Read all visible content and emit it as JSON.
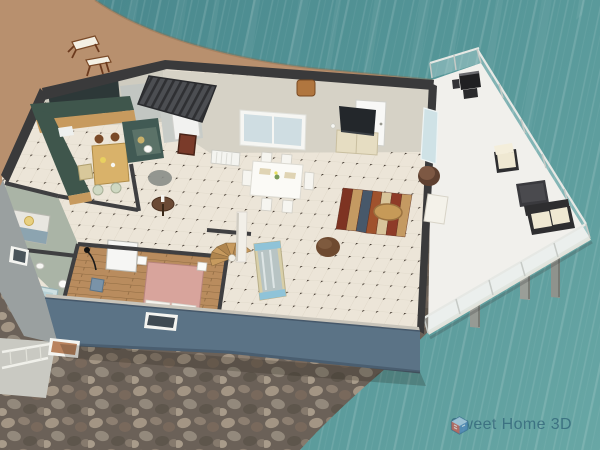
{
  "app": {
    "watermark_text": "Sweet Home 3D"
  },
  "view": {
    "type": "3d-aerial-home-render",
    "description": "Aerial 3D view of a furnished single-storey beach house built on stilts over a pebble shore and teal sea, with a white railed terrace deck, sandy beach with two wooden deck chairs at top left"
  },
  "rooms": [
    {
      "id": "kitchen",
      "label": "kitchen with L-shaped teal counter and small wooden table"
    },
    {
      "id": "wc",
      "label": "dark teal water closet"
    },
    {
      "id": "dining-area",
      "label": "dining area with white table and four chairs"
    },
    {
      "id": "living-room",
      "label": "living room with TV cabinet, striped rug, armchair, leaning mirror, spiral stairs"
    },
    {
      "id": "bedroom",
      "label": "bedroom with pink double bed on wood floor"
    },
    {
      "id": "bathroom",
      "label": "bathroom with tub, toilet and sink"
    },
    {
      "id": "small-bedroom",
      "label": "small bedroom with lamp"
    },
    {
      "id": "deck-terrace",
      "label": "white terrace with glass railing, grill and outdoor lounge set"
    }
  ],
  "environment": {
    "water": "sea",
    "beach": "sand with two wooden deck chairs",
    "shore": "pebble stones",
    "supports": "concrete stilt pillars under deck"
  },
  "colors": {
    "water_deep": "#47858b",
    "water_mid": "#549597",
    "water_light": "#68a7a5",
    "sand": "#b8906e",
    "pebble_base": "#6b6158",
    "wall_cut": "#3a3a3b",
    "wall_face": "#d6d2c6",
    "wall_blue": "#5b7386",
    "floor_tile": "#ece5d8",
    "wood_floor": "#b98c5e",
    "counter_teal": "#3f564c",
    "deck_white": "#f1f0ec",
    "rug_red": "#8e3b28",
    "bed_pink": "#d8a49c",
    "roof_dark": "#4c4e52",
    "logo_text": "#2e6076"
  }
}
